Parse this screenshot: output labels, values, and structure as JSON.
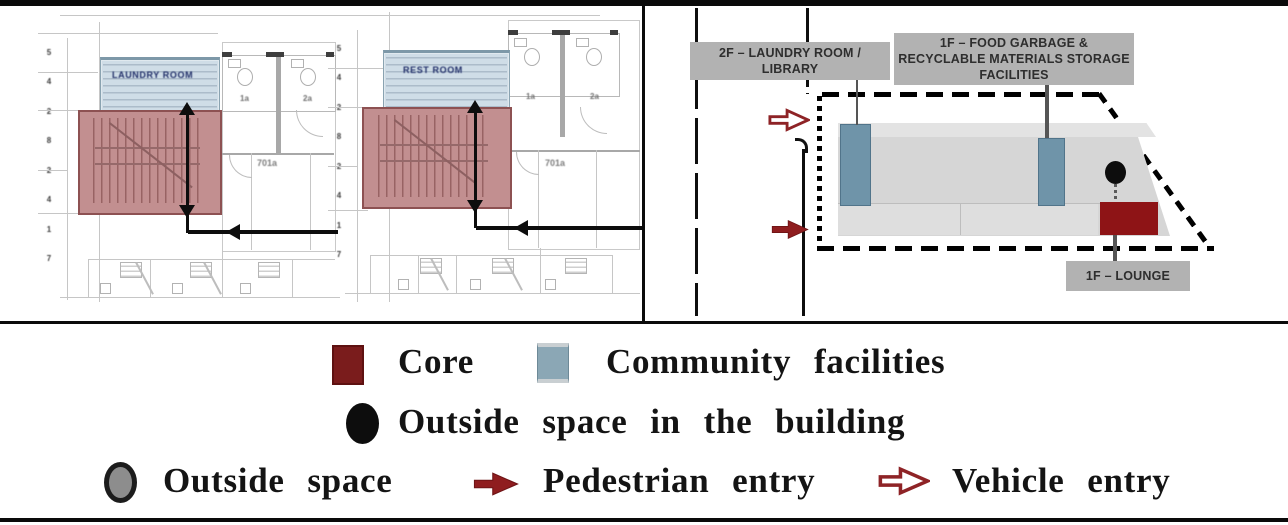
{
  "floor_plans": {
    "plans": [
      {
        "facility_label": "LAUNDRY ROOM",
        "room_label": "701a",
        "unit_labels": [
          "1a",
          "2a"
        ],
        "dim_ticks": [
          "5",
          "4",
          "2",
          "8",
          "2",
          "4",
          "1",
          "7"
        ]
      },
      {
        "facility_label": "REST ROOM",
        "room_label": "701a",
        "unit_labels": [
          "1a",
          "2a"
        ],
        "dim_ticks": [
          "5",
          "4",
          "2",
          "8",
          "2",
          "4",
          "1",
          "7"
        ]
      }
    ]
  },
  "site_diagram": {
    "label_laundry": "2F – LAUNDRY ROOM / LIBRARY",
    "label_storage": "1F – FOOD GARBAGE & RECYCLABLE MATERIALS STORAGE FACILITIES",
    "label_lounge": "1F – LOUNGE"
  },
  "legend": {
    "core": "Core",
    "community": "Community facilities",
    "outside_in_building": "Outside space in the building",
    "outside": "Outside space",
    "pedestrian": "Pedestrian entry",
    "vehicle": "Vehicle entry"
  },
  "colors": {
    "core_swatch": "#7a1c1c",
    "community_swatch": "#8ba7b5",
    "site_core": "#8e1416",
    "site_community": "#6f94a9",
    "plan_core_overlay": "#c28f90",
    "plan_community_overlay": "#cfdde7",
    "pedestrian_arrow": "#8f1d1f",
    "vehicle_arrow_outline": "#8e2326",
    "site_label_bg": "#b2b2b2"
  }
}
